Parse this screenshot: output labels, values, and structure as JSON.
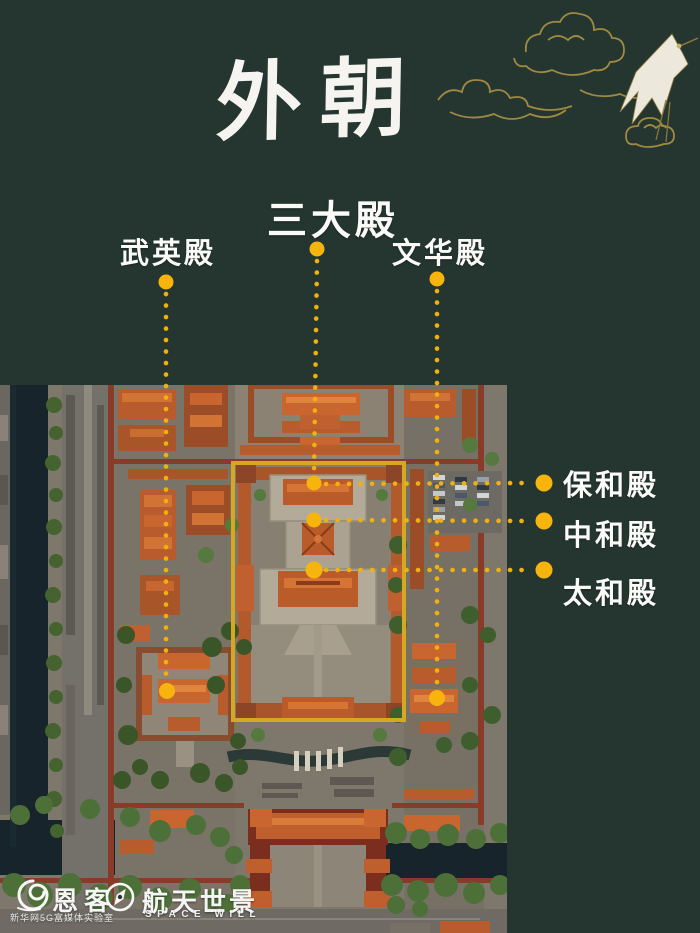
{
  "title": "外朝",
  "annotations": {
    "top": [
      {
        "id": "sandadian",
        "label": "三大殿"
      },
      {
        "id": "wuyingdian",
        "label": "武英殿"
      },
      {
        "id": "wenhuadian",
        "label": "文华殿"
      }
    ],
    "right": [
      {
        "id": "baohedian",
        "label": "保和殿"
      },
      {
        "id": "zhonghedian",
        "label": "中和殿"
      },
      {
        "id": "taihedian",
        "label": "太和殿"
      }
    ]
  },
  "footer": {
    "enke_name": "恩客",
    "enke_subtitle": "新华网5G富媒体实验室",
    "spacewill_name": "航天世景",
    "spacewill_subtitle": "SPACE WILL"
  },
  "colors": {
    "background": "#253631",
    "accent_gold": "#f6b40c",
    "highlight_box": "#d4a820",
    "label_text": "#ffffff",
    "cloud_gold": "#a68f42"
  }
}
